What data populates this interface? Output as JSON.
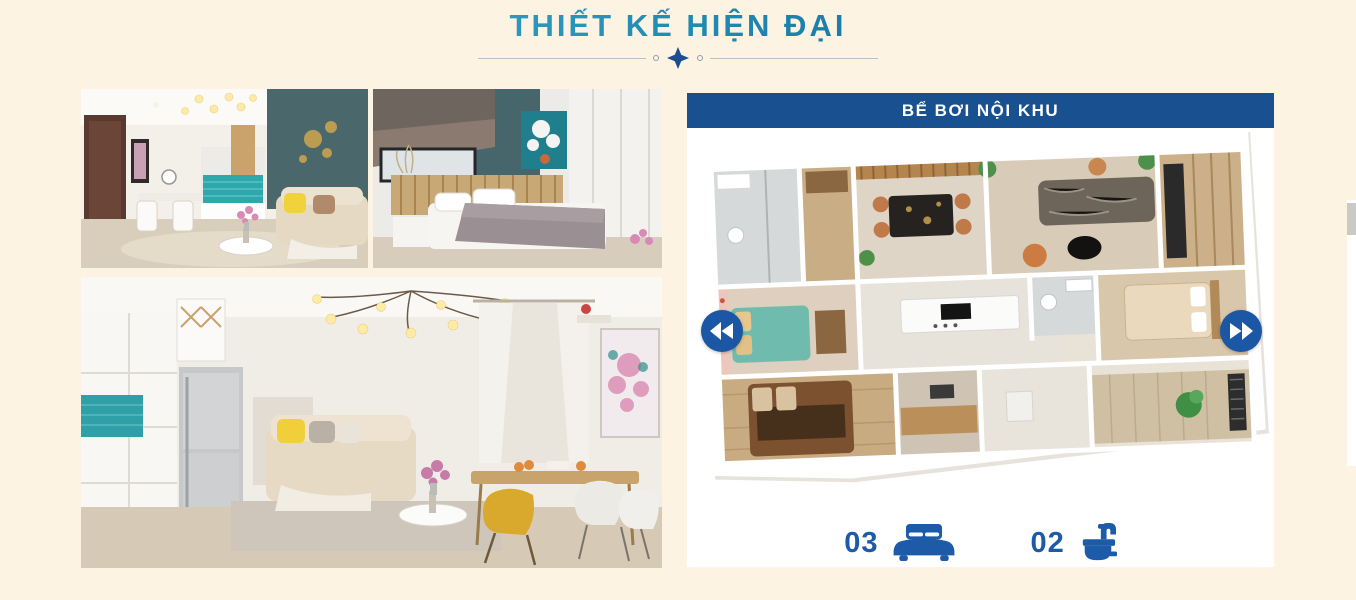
{
  "page": {
    "background_color": "#fcf3e3"
  },
  "header": {
    "title": "THIẾT KẾ HIỆN ĐẠI",
    "title_color_start": "#6cc2da",
    "title_color_end": "#153f72",
    "divider_diamond_color": "#1b4d8f",
    "divider_line_color": "#b6bfca"
  },
  "gallery": {
    "photos": [
      {
        "name": "living-dining-room"
      },
      {
        "name": "bedroom"
      },
      {
        "name": "large-living-room"
      }
    ]
  },
  "floorplan_card": {
    "title": "BỂ BƠI NỘI KHU",
    "title_bg": "#19508f",
    "title_text_color": "#ffffff",
    "nav": {
      "prev_icon": "double-chevron-left-icon",
      "next_icon": "double-chevron-right-icon",
      "arrow_bg": "#1b57a5"
    },
    "stats": [
      {
        "id": "bedrooms",
        "value": "03",
        "icon": "bed-icon"
      },
      {
        "id": "bathrooms",
        "value": "02",
        "icon": "washbasin-icon"
      }
    ],
    "stat_color": "#1d5ba8"
  }
}
